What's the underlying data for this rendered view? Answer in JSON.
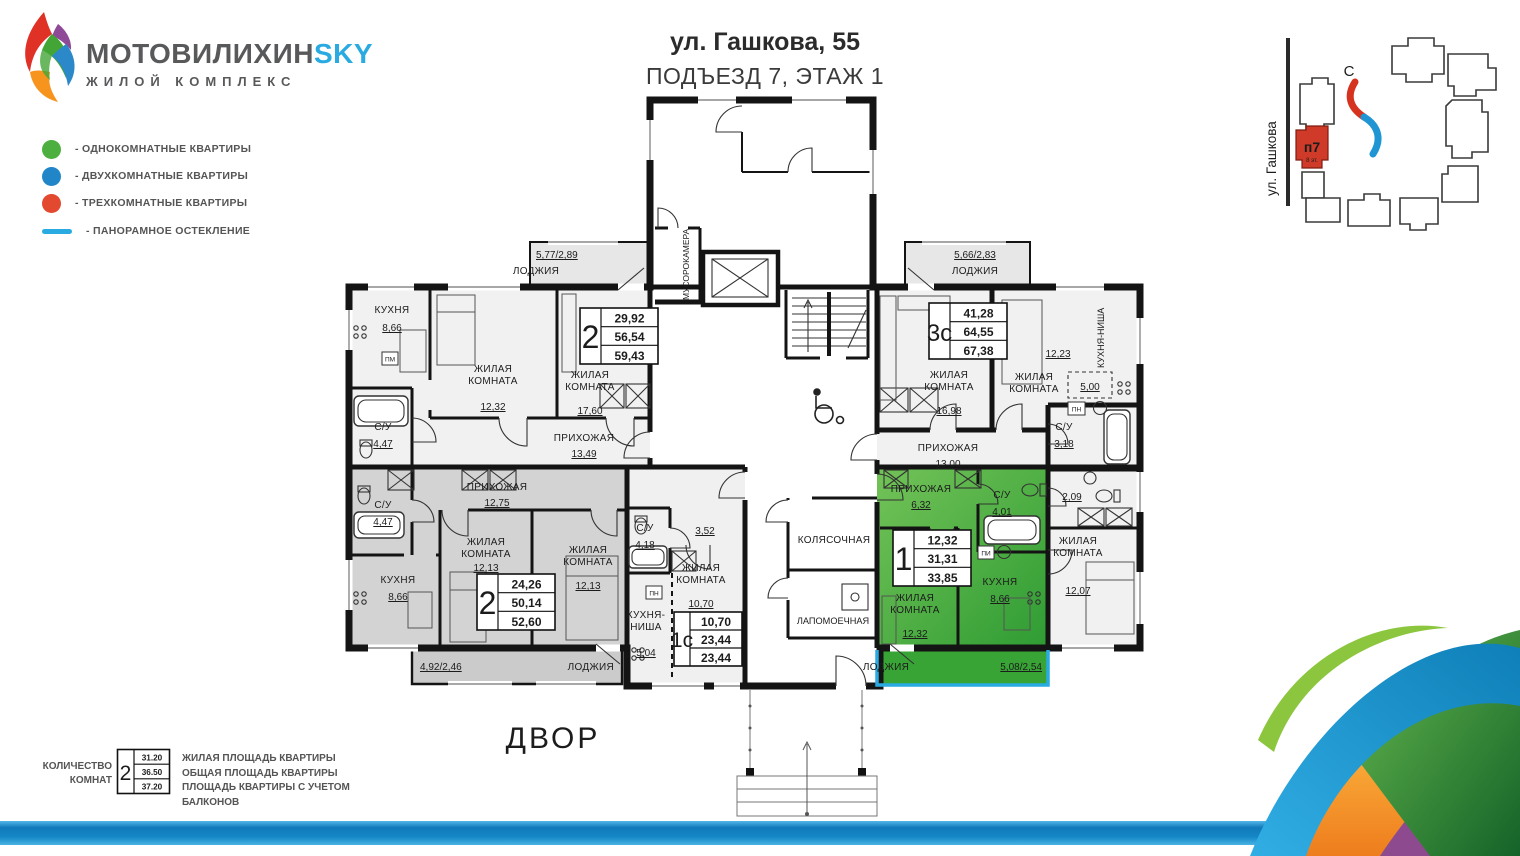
{
  "header": {
    "brand_main": "МОТОВИЛИХИН",
    "brand_accent": "SKY",
    "brand_sub": "ЖИЛОЙ КОМПЛЕКС"
  },
  "legend": {
    "items": [
      {
        "label": "- ОДНОКОМНАТНЫЕ КВАРТИРЫ",
        "color": "#4caf3f"
      },
      {
        "label": "- ДВУХКОМНАТНЫЕ КВАРТИРЫ",
        "color": "#2086c8"
      },
      {
        "label": "- ТРЕХКОМНАТНЫЕ КВАРТИРЫ",
        "color": "#e2492f"
      },
      {
        "label": "- ПАНОРАМНОЕ ОСТЕКЛЕНИЕ",
        "color": "#29abe2"
      }
    ]
  },
  "title": {
    "address": "ул. Гашкова, 55",
    "entrance": "ПОДЪЕЗД 7, ЭТАЖ 1"
  },
  "minimap": {
    "street": "ул. Гашкова",
    "block": "п7",
    "block_floors": "8 эт.",
    "compass": "С"
  },
  "plan": {
    "yard": "ДВОР",
    "common": {
      "trash": "МУСОРОКАМЕРА",
      "stroller": "КОЛЯСОЧНАЯ",
      "paw_wash": "ЛАПОМОЕЧНАЯ"
    },
    "markers": {
      "pm": "ПМ",
      "pn": "ПН",
      "pi": "ПИ"
    },
    "apartments": [
      {
        "badge": "2",
        "areas": [
          "29,92",
          "56,54",
          "59,43"
        ],
        "rooms": {
          "kitchen": {
            "label": "КУХНЯ",
            "area": "8,66"
          },
          "room1": {
            "label": "ЖИЛАЯ\nКОМНАТА",
            "area": "12,32"
          },
          "room2": {
            "label": "ЖИЛАЯ\nКОМНАТА",
            "area": "17,60"
          },
          "bath": {
            "label": "С/У",
            "area": "4,47"
          },
          "hall": {
            "label": "ПРИХОЖАЯ",
            "area": "13,49"
          },
          "loggia": {
            "label": "ЛОДЖИЯ",
            "area": "5,77/2,89"
          }
        }
      },
      {
        "badge": "3с",
        "areas": [
          "41,28",
          "64,55",
          "67,38"
        ],
        "rooms": {
          "room1": {
            "label": "ЖИЛАЯ\nКОМНАТА",
            "area": "16,98"
          },
          "room2": {
            "label": "ЖИЛАЯ\nКОМНАТА",
            "area": "12,23"
          },
          "kitchen_niche": {
            "label": "КУХНЯ-НИША",
            "area": "5,00"
          },
          "bath1": {
            "label": "С/У",
            "area": "3,18"
          },
          "bath2": {
            "area": "2,09"
          },
          "room3": {
            "label": "ЖИЛАЯ\nКОМНАТА",
            "area": "12,07"
          },
          "hall": {
            "label": "ПРИХОЖАЯ",
            "area": "13,00"
          },
          "loggia": {
            "label": "ЛОДЖИЯ",
            "area": "5,66/2,83"
          }
        }
      },
      {
        "badge": "2",
        "areas": [
          "24,26",
          "50,14",
          "52,60"
        ],
        "rooms": {
          "bath": {
            "label": "С/У",
            "area": "4,47"
          },
          "hall": {
            "label": "ПРИХОЖАЯ",
            "area": "12,75"
          },
          "kitchen": {
            "label": "КУХНЯ",
            "area": "8,66"
          },
          "room1": {
            "label": "ЖИЛАЯ\nКОМНАТА",
            "area": "12,13"
          },
          "room2": {
            "label": "ЖИЛАЯ\nКОМНАТА",
            "area": "12,13"
          },
          "loggia": {
            "label": "ЛОДЖИЯ",
            "area": "4,92/2,46"
          }
        }
      },
      {
        "badge": "1с",
        "areas": [
          "10,70",
          "23,44",
          "23,44"
        ],
        "rooms": {
          "bath": {
            "label": "С/У",
            "area": "4,18"
          },
          "hall": {
            "area": "3,52"
          },
          "room1": {
            "label": "ЖИЛАЯ\nКОМНАТА",
            "area": "10,70"
          },
          "kitchen_niche": {
            "label": "КУХНЯ-\nНИША",
            "area": "5,04"
          }
        }
      },
      {
        "badge": "1",
        "areas": [
          "12,32",
          "31,31",
          "33,85"
        ],
        "rooms": {
          "hall": {
            "label": "ПРИХОЖАЯ",
            "area": "6,32"
          },
          "bath": {
            "label": "С/У",
            "area": "4,01"
          },
          "room1": {
            "label": "ЖИЛАЯ\nКОМНАТА",
            "area": "12,32"
          },
          "kitchen": {
            "label": "КУХНЯ",
            "area": "8,66"
          },
          "loggia": {
            "label": "ЛОДЖИЯ",
            "area": "5,08/2,54"
          }
        }
      }
    ]
  },
  "footer_key": {
    "rooms_label": "КОЛИЧЕСТВО\nКОМНАТ",
    "sample_count": "2",
    "sample_values": [
      "31.20",
      "36.50",
      "37.20"
    ],
    "descriptions": [
      "ЖИЛАЯ ПЛОЩАДЬ КВАРТИРЫ",
      "ОБЩАЯ ПЛОЩАДЬ КВАРТИРЫ",
      "ПЛОЩАДЬ КВАРТИРЫ С УЧЕТОМ БАЛКОНОВ"
    ]
  },
  "colors": {
    "accent_blue": "#29abe2",
    "green_apartment": "#49a53e",
    "one_room_dot": "#4caf3f",
    "two_room_dot": "#2086c8",
    "three_room_dot": "#e2492f"
  }
}
